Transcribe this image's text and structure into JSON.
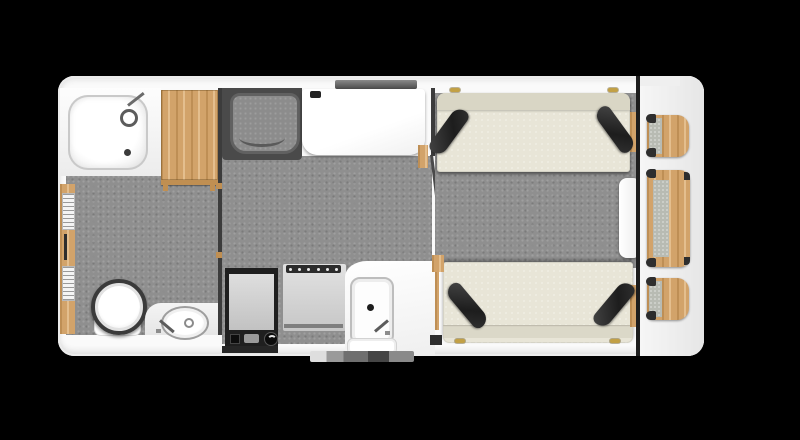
{
  "scene": {
    "kind": "caravan-floorplan",
    "background_color": "#000000",
    "body_color": "#fafafa",
    "floor_color": "#8f8f8f",
    "wood_color": "#d2a36a",
    "upholstery_color": "#e8e5d7",
    "cushion_color": "#242424",
    "wall_color": "#3c3c3c",
    "hinge_color": "#c2a045"
  },
  "rooms": {
    "washroom": {
      "label": "washroom",
      "items": [
        "shower-tray",
        "wardrobe",
        "toilet",
        "basin",
        "service-door"
      ]
    },
    "kitchen_living": {
      "label": "kitchen-living",
      "items": [
        "cab-seat",
        "wall-table",
        "fridge",
        "cooker",
        "kitchen-sink",
        "worktop",
        "entry-door",
        "entry-step",
        "window"
      ]
    },
    "lounge": {
      "label": "rear-lounge",
      "items": [
        "bench-top",
        "bench-bottom",
        "scatter-cushions",
        "stowed-table",
        "shelf-top",
        "drawer-chest",
        "shelf-bottom"
      ]
    }
  },
  "furniture_titles": {
    "shower": "shower tray",
    "wardrobe": "wardrobe",
    "toilet": "toilet",
    "basin": "washbasin",
    "cab_seat": "cab seat",
    "table": "wall table",
    "fridge": "fridge",
    "cooker": "cooker",
    "sink": "kitchen sink",
    "bench_top": "lounge bench",
    "bench_bottom": "lounge bench",
    "stowed_table": "stowed table",
    "shelf_top": "corner shelf",
    "chest": "drawer chest",
    "shelf_bottom": "corner shelf",
    "entry_door": "entry door",
    "step": "entry step",
    "window": "window"
  }
}
